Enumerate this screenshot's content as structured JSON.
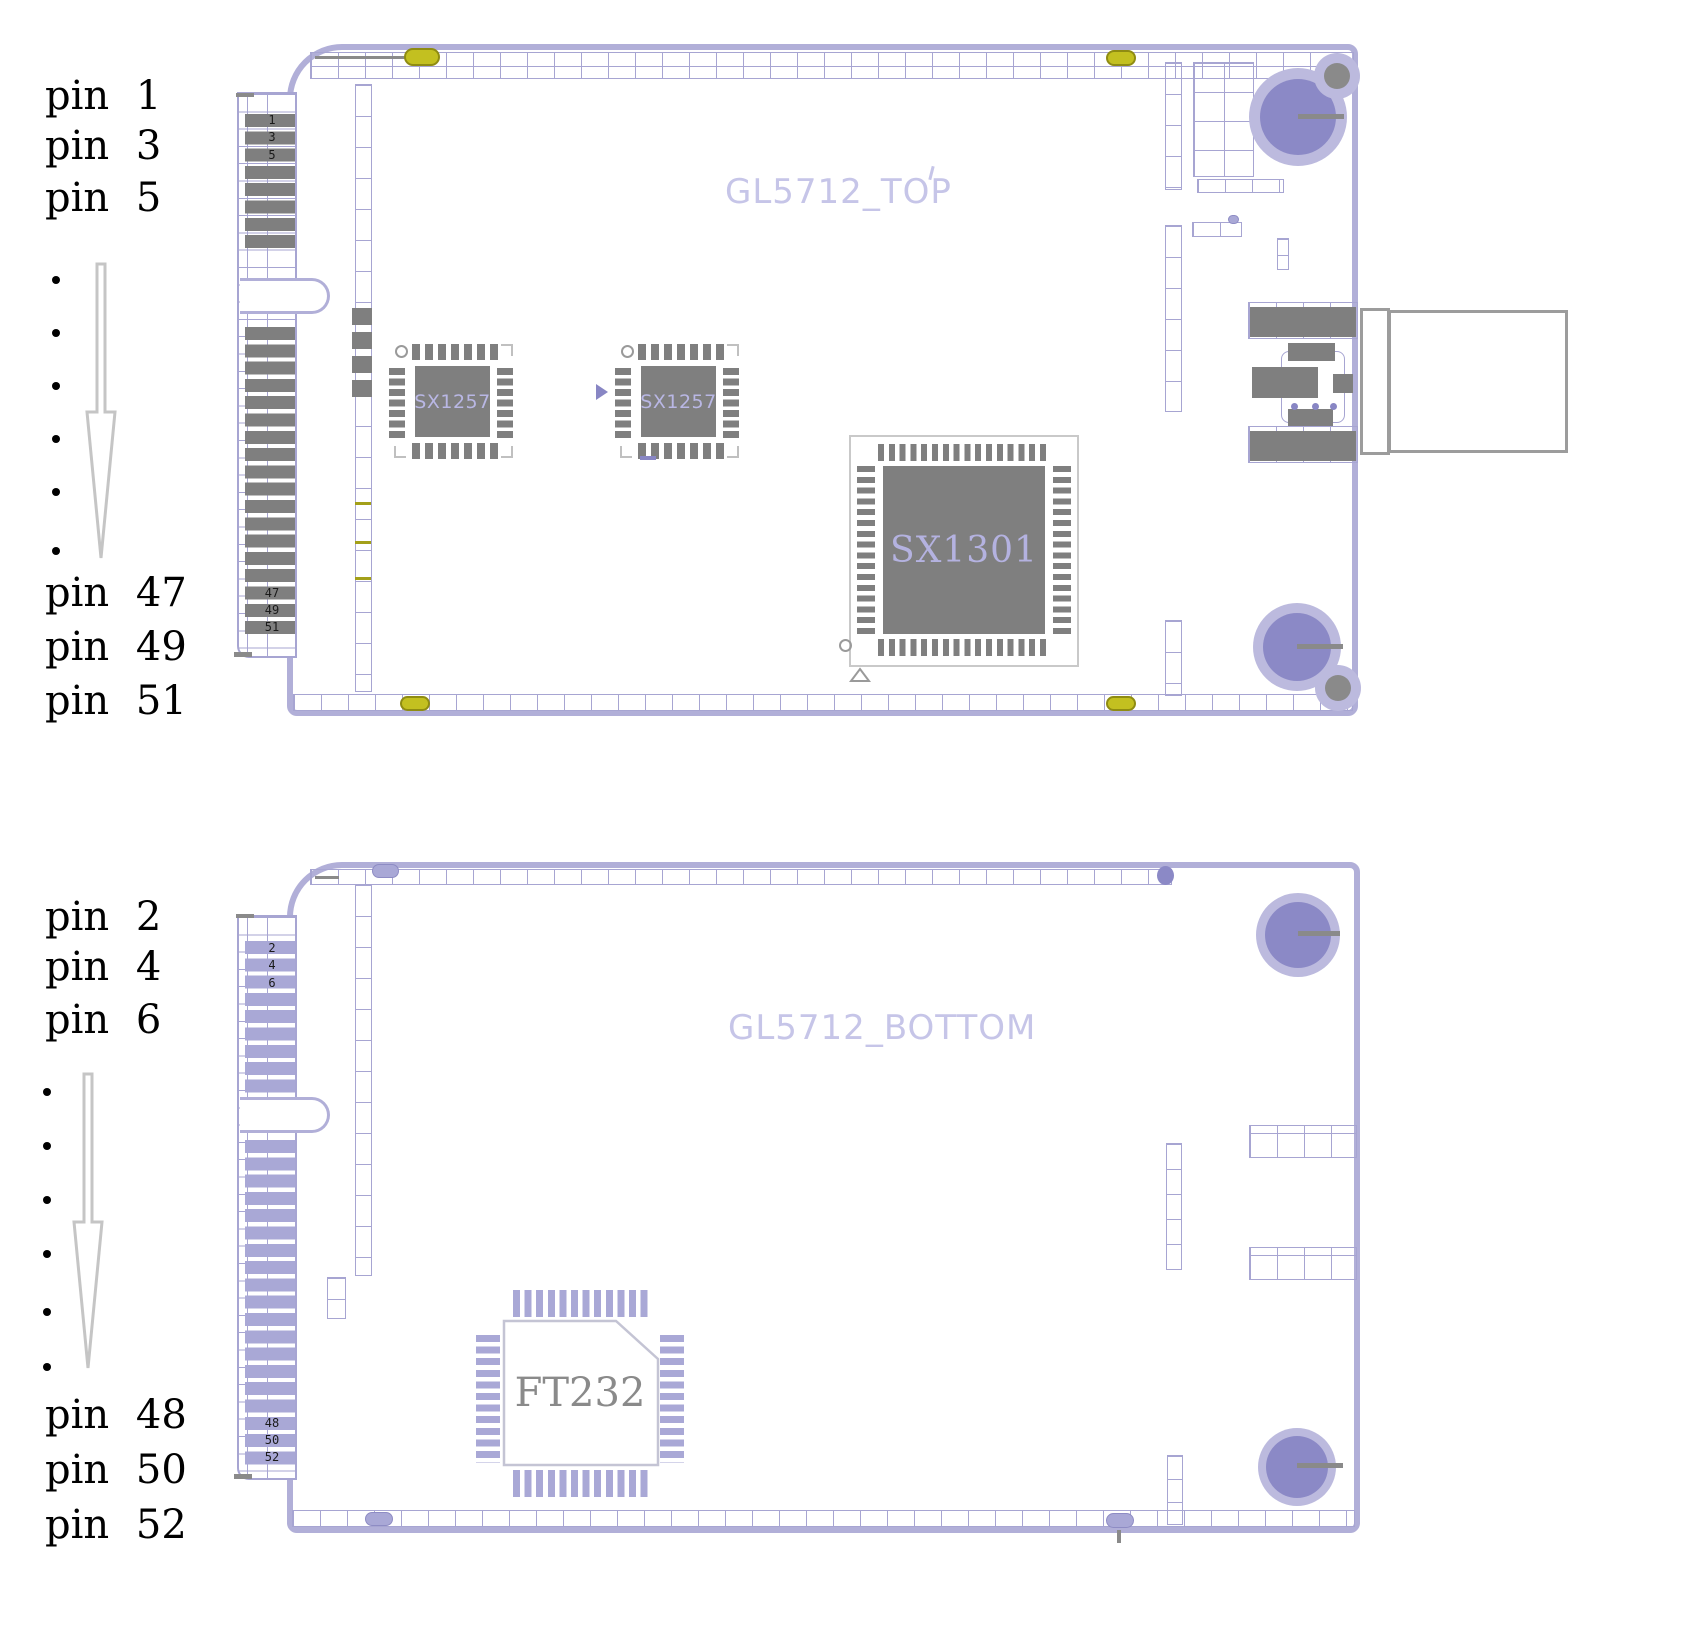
{
  "legend_top": {
    "start": [
      "pin 1",
      "pin 3",
      "pin 5"
    ],
    "end": [
      "pin 47",
      "pin 49",
      "pin 51"
    ]
  },
  "legend_bottom": {
    "start": [
      "pin 2",
      "pin 4",
      "pin 6"
    ],
    "end": [
      "pin 48",
      "pin 50",
      "pin 52"
    ]
  },
  "top_board": {
    "title": "GL5712_TOP",
    "pad_numbers_start": [
      "1",
      "3",
      "5"
    ],
    "pad_numbers_end": [
      "47",
      "49",
      "51"
    ],
    "chips": {
      "sx1257_a": "SX1257",
      "sx1257_b": "SX1257",
      "sx1301": "SX1301"
    }
  },
  "bottom_board": {
    "title": "GL5712_BOTTOM",
    "pad_numbers_start": [
      "2",
      "4",
      "6"
    ],
    "pad_numbers_end": [
      "48",
      "50",
      "52"
    ],
    "chips": {
      "ft232": "FT232"
    }
  },
  "colors": {
    "board_outline": "#b1afd8",
    "grid_line": "#a7a5d2",
    "pad_gray": "#7f7f7f",
    "pad_purple": "#a9a8d6",
    "fiducial_yellow": "#c3c020",
    "hole_ring": "#bcbade",
    "hole_fill": "#8b89c6",
    "silkscreen_text": "#c6c5e8",
    "chip_label_purple": "#b4b2e0",
    "chip_label_gray": "#8a8a8a"
  }
}
